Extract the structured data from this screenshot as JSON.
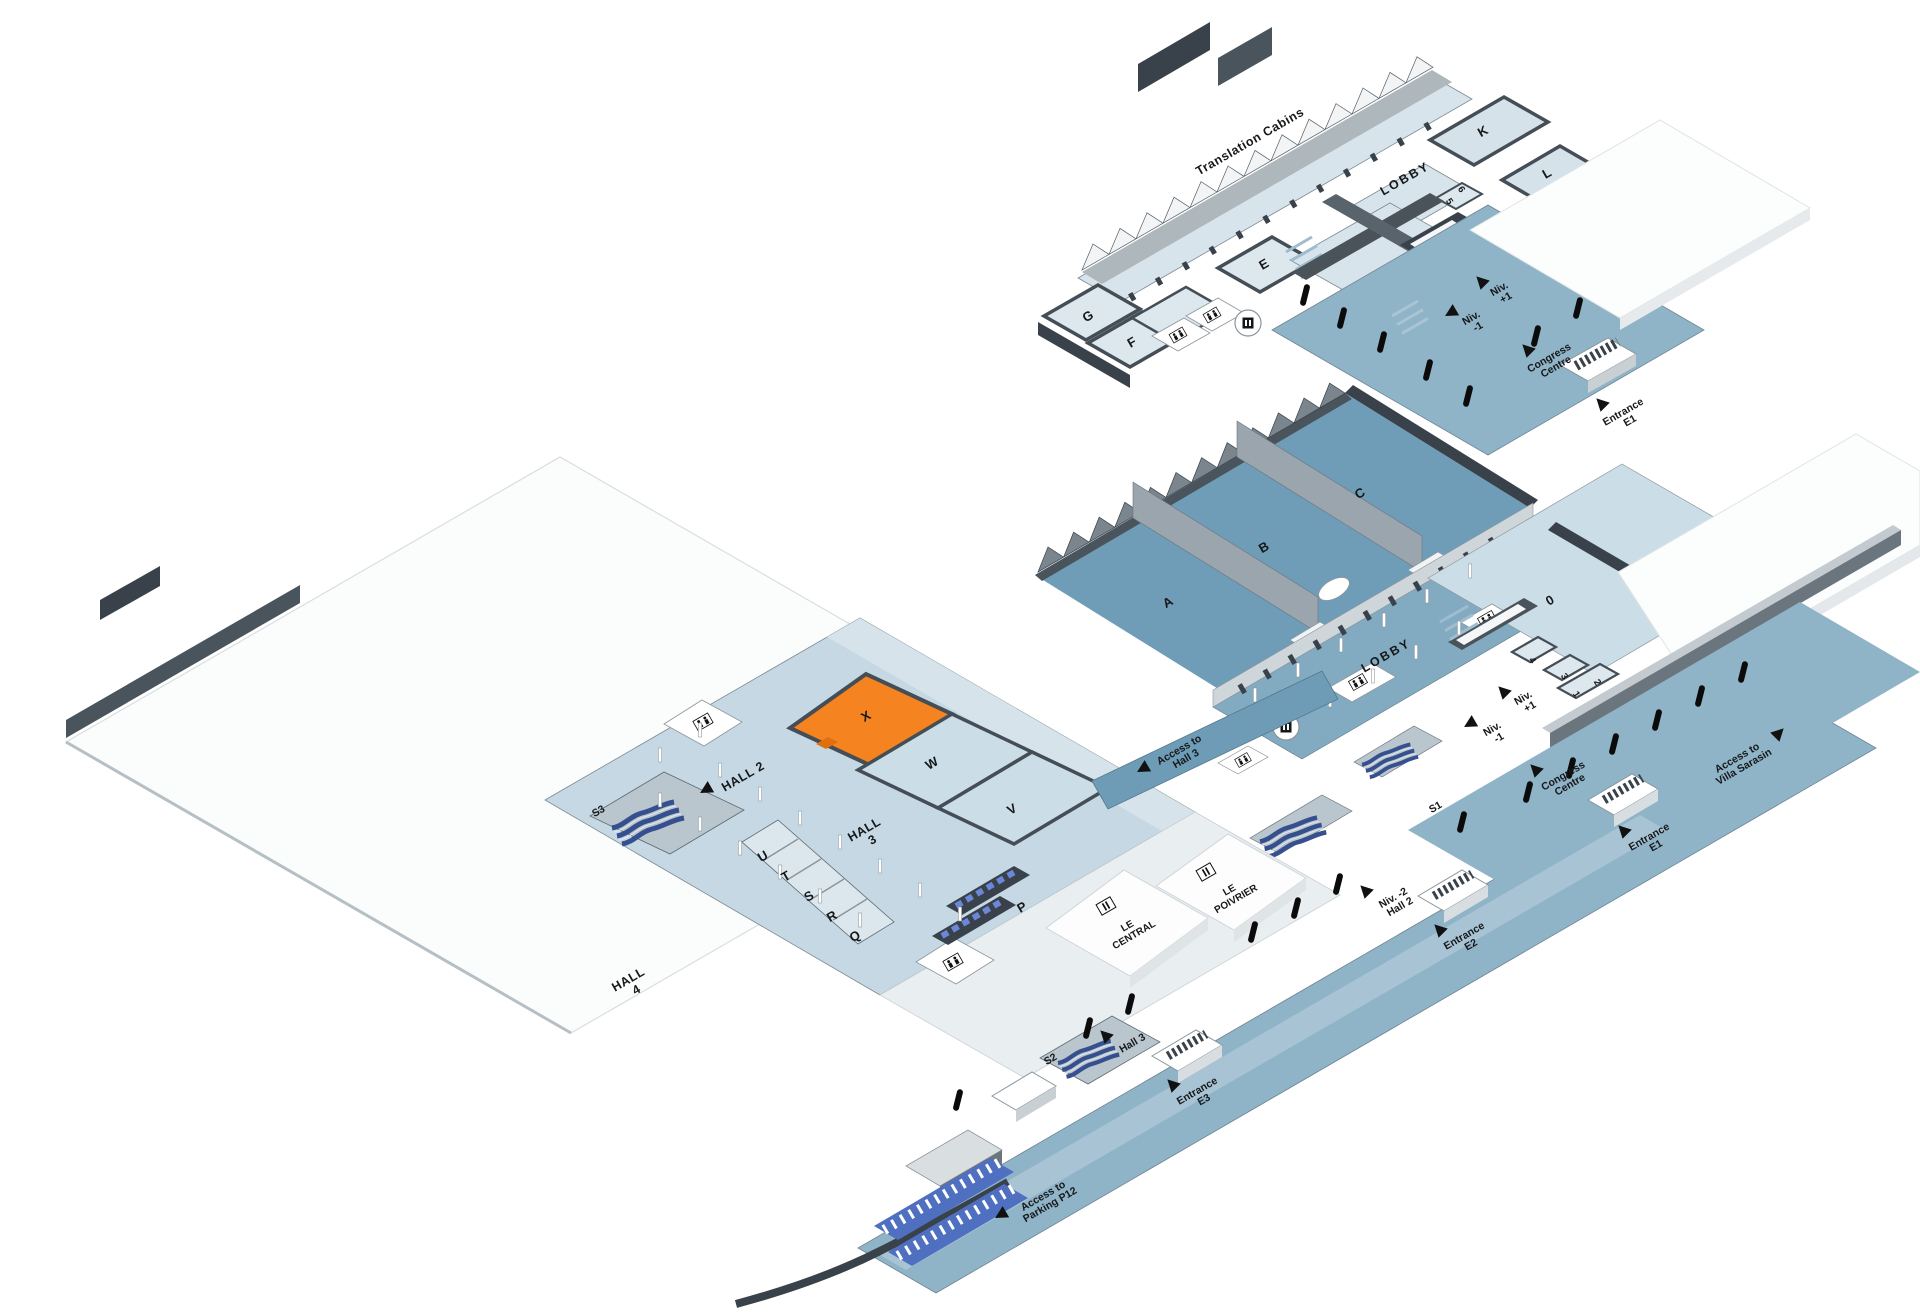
{
  "map": {
    "colors": {
      "highlight": "#F5831F",
      "floor_light": "#CFE0E9",
      "floor_steel": "#8FB3C7",
      "floor_hall": "#6F9DB8",
      "wall_dark": "#3E474F",
      "escalator_blue": "#36508F"
    },
    "upper_level": {
      "translation_cabins": "Translation Cabins",
      "lobby": "LOBBY",
      "room_k": "K",
      "room_l": "L",
      "room_5": "5",
      "room_6": "6",
      "room_e": "E",
      "room_f": "F",
      "room_g": "G",
      "niv_plus_1": [
        "Niv.",
        "+1"
      ],
      "niv_minus_1": [
        "Niv.",
        "-1"
      ],
      "congress_centre": [
        "Congress",
        "Centre"
      ],
      "entrance_e1": [
        "Entrance",
        "E1"
      ]
    },
    "level_0": {
      "hall_a": "A",
      "hall_b": "B",
      "hall_c": "C",
      "lobby": "LOBBY",
      "room_0": "0",
      "room_1": "1",
      "room_2": "2",
      "room_3": "3",
      "room_4": "4",
      "niv_plus_1": [
        "Niv.",
        "+1"
      ],
      "niv_minus_1": [
        "Niv.",
        "-1"
      ],
      "s1": "S1",
      "niv_minus_2_hall_1": [
        "Niv. -2",
        "Hall 1"
      ],
      "niv_minus_2_hall_2": [
        "Niv. -2",
        "Hall 2"
      ],
      "access_hall_3": [
        "Access to",
        "Hall 3"
      ],
      "le_central": [
        "LE",
        "CENTRAL"
      ],
      "le_poivrier": [
        "LE",
        "POIVRIER"
      ]
    },
    "halls": {
      "hall_2": "HALL 2",
      "hall_3": [
        "HALL",
        "3"
      ],
      "hall_4": [
        "HALL",
        "4"
      ],
      "room_x": "X",
      "room_w": "W",
      "room_v": "V",
      "room_u": "U",
      "room_t": "T",
      "room_s": "S",
      "room_r": "R",
      "room_q": "Q",
      "room_p": "P",
      "s2": "S2",
      "s3": "S3"
    },
    "promenade": {
      "hall_3_door": "Hall 3",
      "entrance_e3": [
        "Entrance",
        "E3"
      ],
      "entrance_e2": [
        "Entrance",
        "E2"
      ],
      "entrance_e1": [
        "Entrance",
        "E1"
      ],
      "congress_centre": [
        "Congress",
        "Centre"
      ],
      "villa_sarasin": [
        "Access to",
        "Villa Sarasin"
      ],
      "parking": [
        "Access to",
        "Parking P12"
      ]
    }
  }
}
